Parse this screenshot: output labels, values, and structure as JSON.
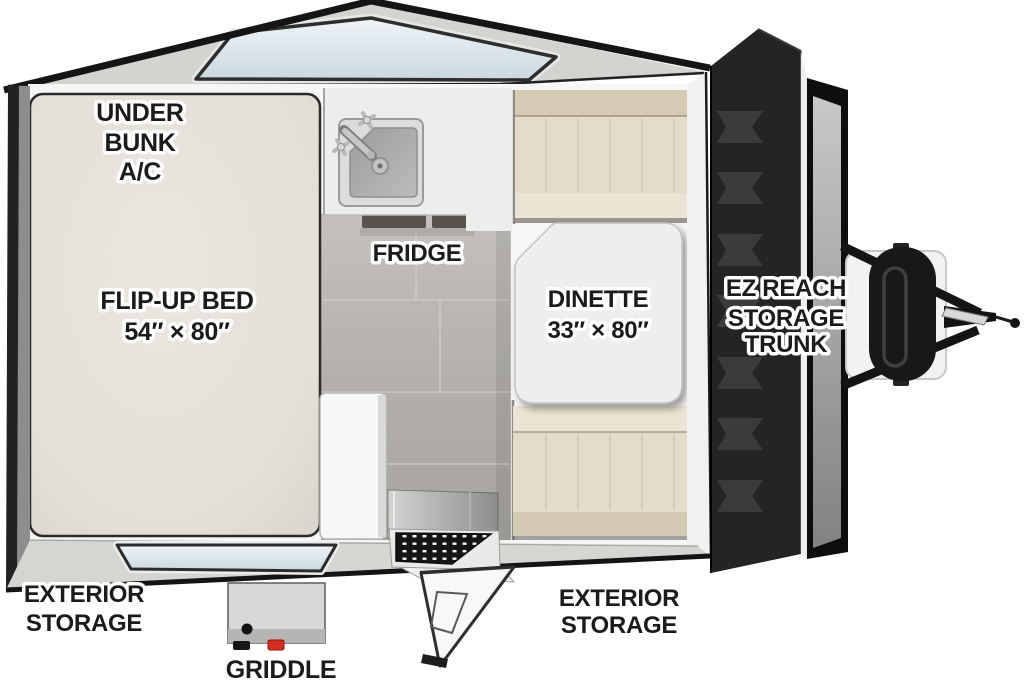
{
  "floorplan": {
    "labels": {
      "under_bunk_ac": {
        "lines": [
          "UNDER",
          "BUNK",
          "A/C"
        ]
      },
      "flip_up_bed": {
        "lines": [
          "FLIP-UP BED",
          "54″ × 80″"
        ]
      },
      "fridge": {
        "text": "FRIDGE"
      },
      "dinette": {
        "lines": [
          "DINETTE",
          "33″ × 80″"
        ]
      },
      "ez_reach_storage_trunk": {
        "lines": [
          "EZ REACH",
          "STORAGE",
          "TRUNK"
        ]
      },
      "exterior_storage_left": {
        "lines": [
          "EXTERIOR",
          "STORAGE"
        ]
      },
      "exterior_storage_door_side": {
        "lines": [
          "EXTERIOR",
          "STORAGE"
        ]
      },
      "griddle": {
        "text": "GRIDDLE"
      }
    },
    "colors": {
      "background": "#ffffff",
      "shell_wall_gray": "#d4d3d0",
      "outline_black": "#161616",
      "bed_cream": "#e6e2da",
      "floor_tile_gray": "#b4b1ac",
      "cushion_tan": "#e4dbca",
      "window_glass_blue": "#dde8ee",
      "trunk_door_charcoal": "#242424",
      "label_text": "#1b1b1b",
      "label_halo": "#ffffff",
      "griddle_accent_red": "#d92b1e"
    }
  }
}
